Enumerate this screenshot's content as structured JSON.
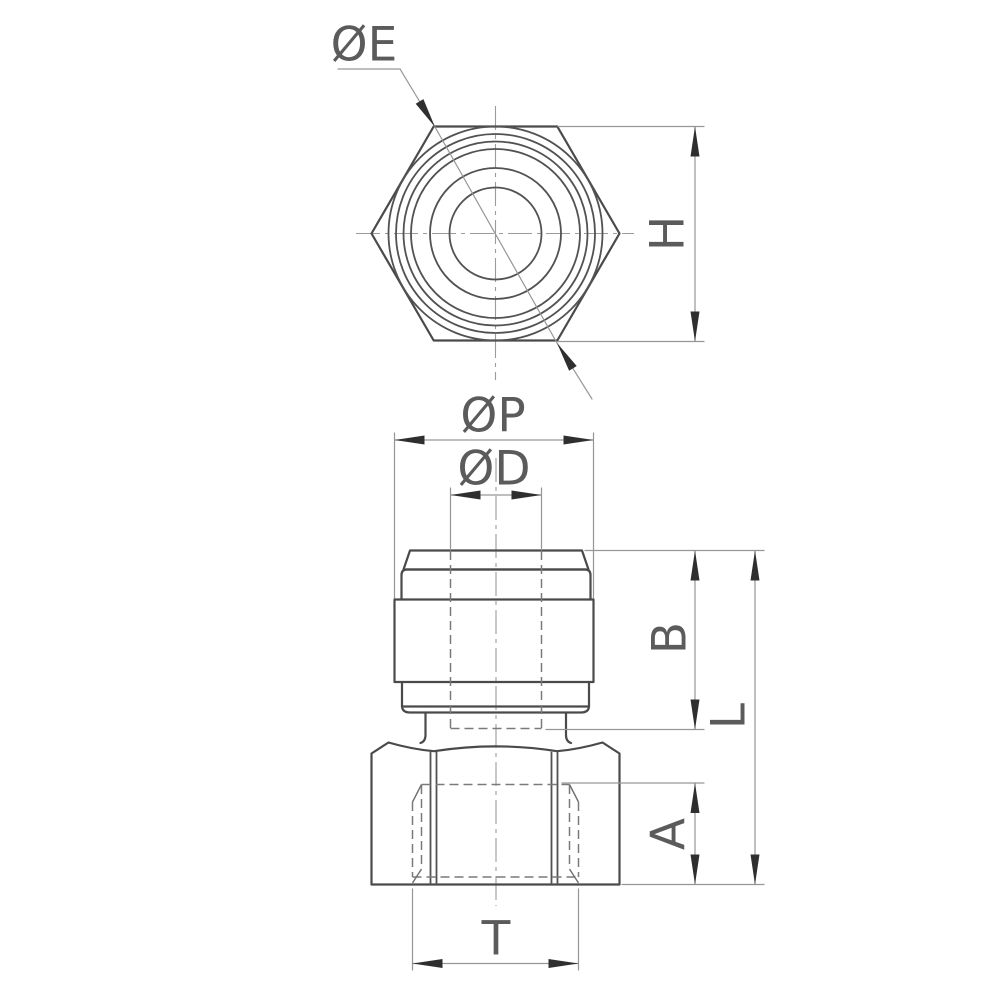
{
  "drawing": {
    "type": "technical-drawing",
    "part": "push-in fitting, female straight connector, two orthographic views",
    "labels": {
      "e": "ØE",
      "h": "H",
      "p": "ØP",
      "d": "ØD",
      "b": "B",
      "l": "L",
      "a": "A",
      "t": "T"
    },
    "colors": {
      "background": "#ffffff",
      "outline": "#4a4a4a",
      "dimension_lines": "#969696",
      "hidden_lines": "#7a7a7a",
      "text": "#5b5b5b",
      "arrow": "#2f2f2f"
    }
  }
}
